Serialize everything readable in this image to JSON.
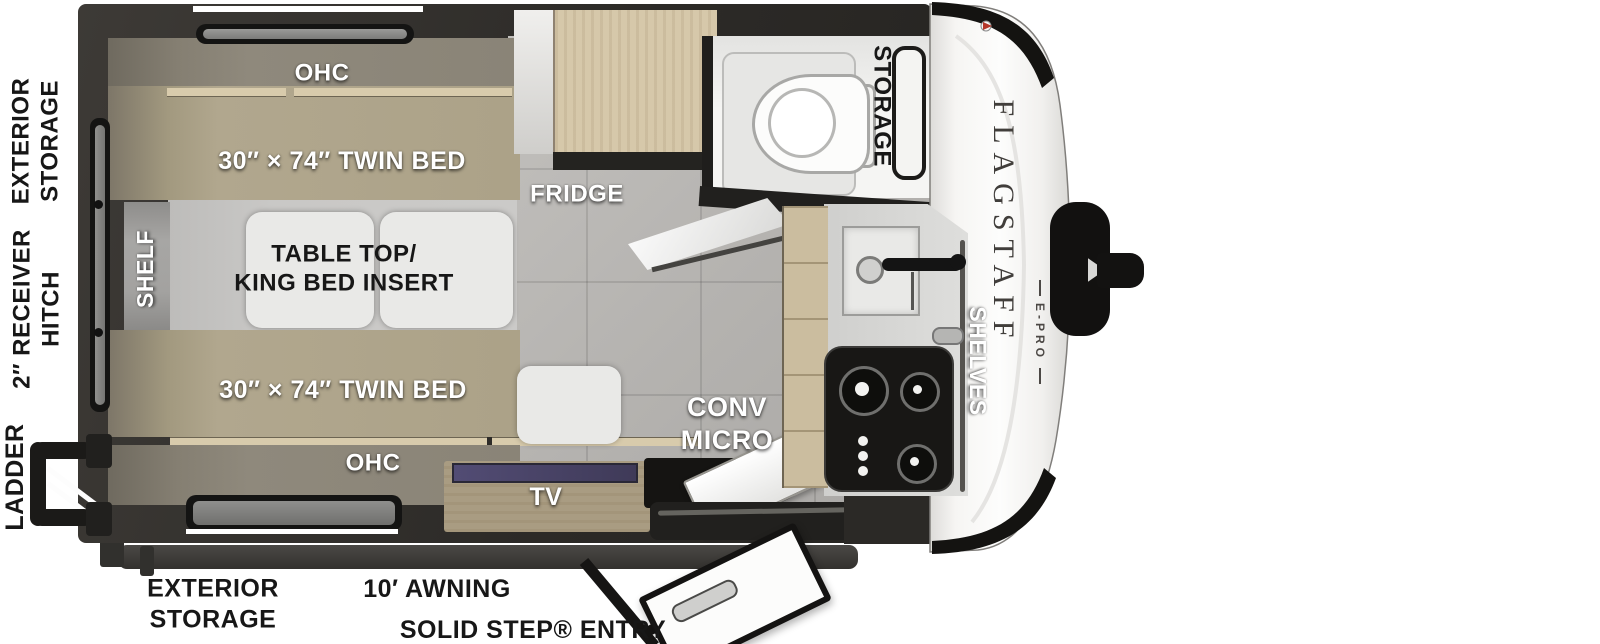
{
  "brand": {
    "name": "FLAGSTAFF",
    "sub": "E-PRO"
  },
  "exterior_labels": {
    "rear_storage_line1": "EXTERIOR",
    "rear_storage_line2": "STORAGE",
    "hitch_line1": "2″ RECEIVER",
    "hitch_line2": "HITCH",
    "ladder": "LADDER",
    "bottom_storage_line1": "EXTERIOR",
    "bottom_storage_line2": "STORAGE",
    "awning": "10′ AWNING",
    "entry": "SOLID STEP® ENTRY"
  },
  "interior_labels": {
    "ohc_top": "OHC",
    "twin_bed_top": "30″ × 74″ TWIN BED",
    "shelf": "SHELF",
    "table_line1": "TABLE TOP/",
    "table_line2": "KING BED INSERT",
    "twin_bed_bottom": "30″ × 74″ TWIN BED",
    "ohc_bottom": "OHC",
    "fridge": "FRIDGE",
    "bath_storage": "STORAGE",
    "conv_micro_line1": "CONV",
    "conv_micro_line2": "MICRO",
    "shelves": "SHELVES",
    "tv": "TV"
  },
  "colors": {
    "wall": "#34312d",
    "mattress": "#b1a78e",
    "wood": "#d2c4a6",
    "floor": "#b9b7b4",
    "counter": "#d8d8d6",
    "cap": "#fbfbfa",
    "black_trim": "#141311",
    "tv_screen": "#474263"
  }
}
